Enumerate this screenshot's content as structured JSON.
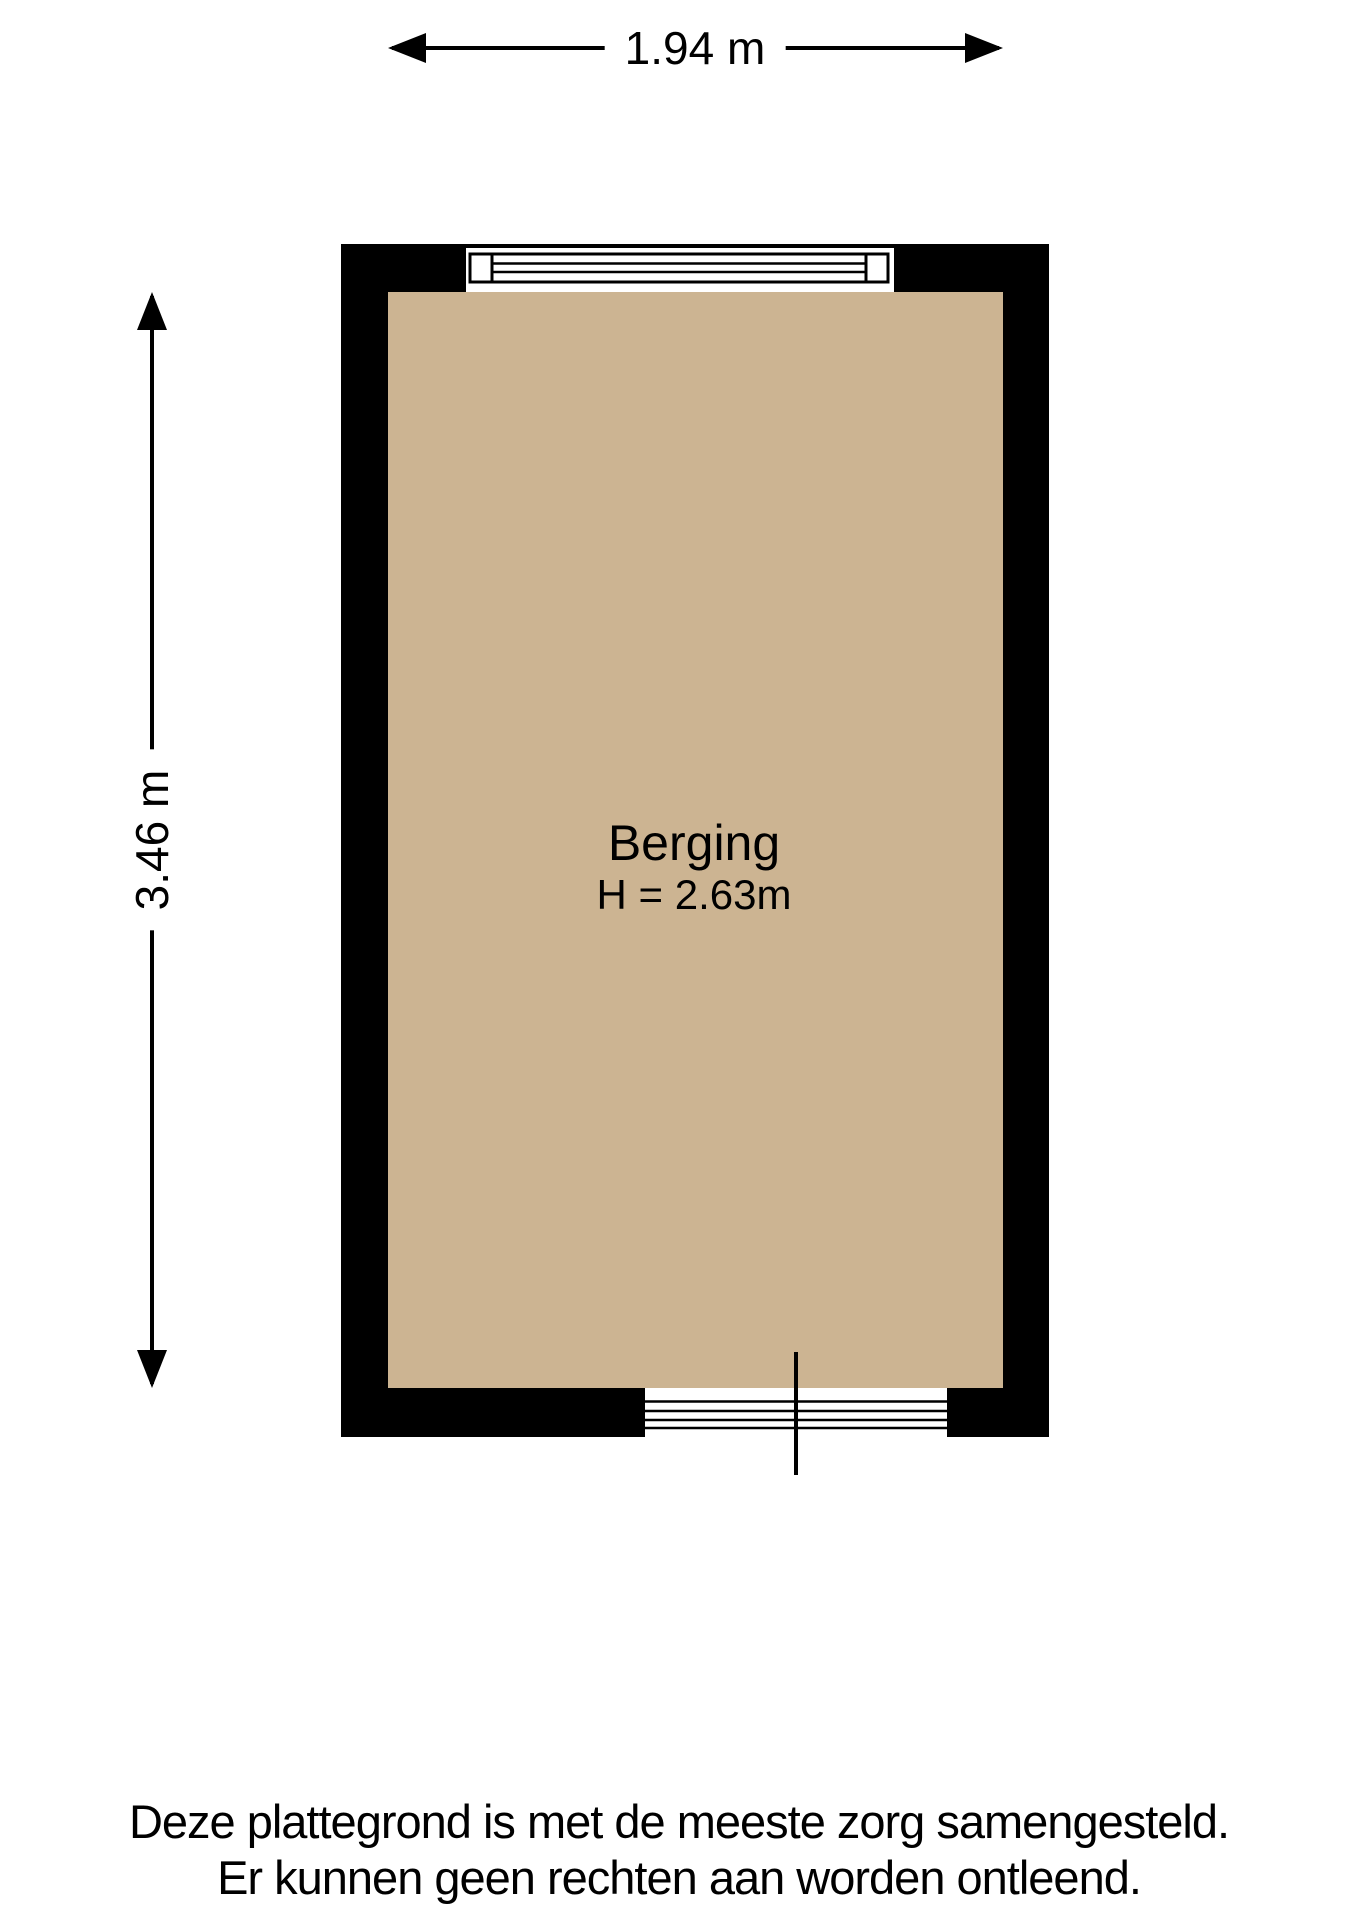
{
  "floorplan": {
    "room": {
      "name": "Berging",
      "ceiling_height": "H = 2.63m"
    },
    "dimensions": {
      "width_label": "1.94 m",
      "height_label": "3.46 m"
    },
    "colors": {
      "wall": "#000000",
      "floor": "#ccb492",
      "line": "#000000"
    },
    "disclaimer": {
      "line1": "Deze plattegrond is met de meeste zorg samengesteld.",
      "line2": "Er kunnen geen rechten aan worden ontleend."
    }
  }
}
